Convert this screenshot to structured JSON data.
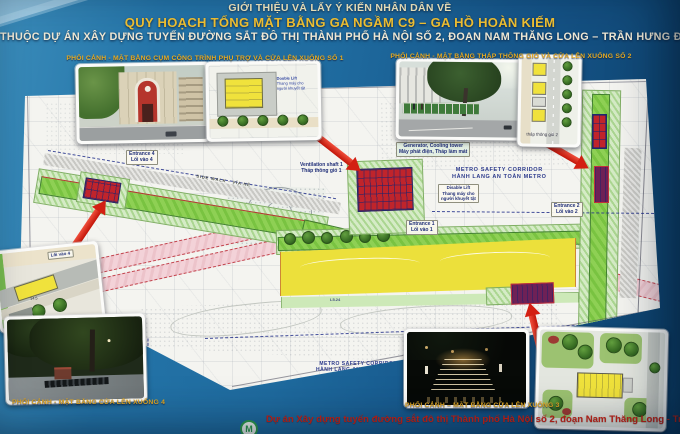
{
  "poster": {
    "title_line1": "GIỚI THIỆU VÀ LẤY Ý KIẾN NHÂN DÂN VỀ",
    "title_line2": "QUY HOẠCH TỔNG MẶT BẰNG GA NGẦM C9 – GA HỒ HOÀN KIẾM",
    "title_line3": "THUỘC DỰ ÁN XÂY DỰNG TUYẾN ĐƯỜNG SẮT ĐÔ THỊ THÀNH PHỐ HÀ NỘI SỐ 2, ĐOẠN NAM THĂNG LONG – TRẦN HƯNG ĐẠO",
    "footer_project": "Dự án Xây dựng tuyến đường sắt đô thị Thành phố Hà Nội số 2, đoạn Nam Thăng Long - Trần Hưng Đạo",
    "logo_letter": "M"
  },
  "captions": {
    "aux_cluster_entrance1": "PHỐI CẢNH - MẶT BẰNG CỤM CÔNG TRÌNH PHỤ TRỢ VÀ CỬA LÊN XUỐNG SỐ 1",
    "vent_tower_entrance2": "PHỐI CẢNH - MẶT BẰNG THÁP THÔNG GIÓ VÀ  CỬA LÊN XUỐNG SỐ 2",
    "entrance4": "PHỐI CẢNH - MẶT BẰNG CỬA LÊN XUỐNG 4",
    "entrance3": "PHỐI CẢNH – MẶT BẰNG  CỬA LÊN XUỐNG 3"
  },
  "map": {
    "entrance1_en": "Entrance 1",
    "entrance1_vi": "Lối vào 1",
    "entrance2_en": "Entrance 2",
    "entrance2_vi": "Lối vào 2",
    "entrance4_en": "Entrance 4",
    "entrance4_vi": "Lối vào 4",
    "vent1_en": "Ventilation shaft 1",
    "vent1_vi": "Tháp thông gió 1",
    "generator_en": "Generator, Cooling tower",
    "generator_vi": "Máy phát điện, Tháp làm mát",
    "lift_en": "Disable Lift",
    "lift_vi1": "Thang máy cho",
    "lift_vi2": "người khuyết tật",
    "safety_en": "METRO SAFETY CORRIDOR",
    "safety_vi": "HÀNH LANG AN TOÀN METRO",
    "sidewalk": "SIDE WALK - VỈA HÈ",
    "toilet_l1": "Nhà vệ sinh",
    "toilet_l2": "công cộng hiện tại",
    "dim1": "L5.24"
  },
  "insets": {
    "plan1_lift_en": "Double Lift",
    "plan1_lift_vi": "Thang máy cho người khuyết tật",
    "plan2_caption": "tháp thông gió 2",
    "plan4_label": "Lối vào 4",
    "plan4_dim": "14.5"
  },
  "colors": {
    "poster_blue": "#1f6b9f",
    "sheet_white": "#f4f4f0",
    "title_gold": "#f2c232",
    "title_cream": "#f7edc3",
    "title_white": "#efe9d6",
    "caption_gold": "#e6ab22",
    "footer_red": "#cd2417",
    "arrow_red": "#c21408",
    "corridor_green": "#7cc341",
    "corridor_pale": "#cde9b8",
    "park_yellow": "#ece03b",
    "road_pink": "#f0ccd2",
    "entrance_red": "#c0242b",
    "entrance_purple": "#6e2156",
    "tree_green": "#3f7d2c",
    "label_navy": "#223079",
    "logo_green": "#2e9e4c"
  }
}
